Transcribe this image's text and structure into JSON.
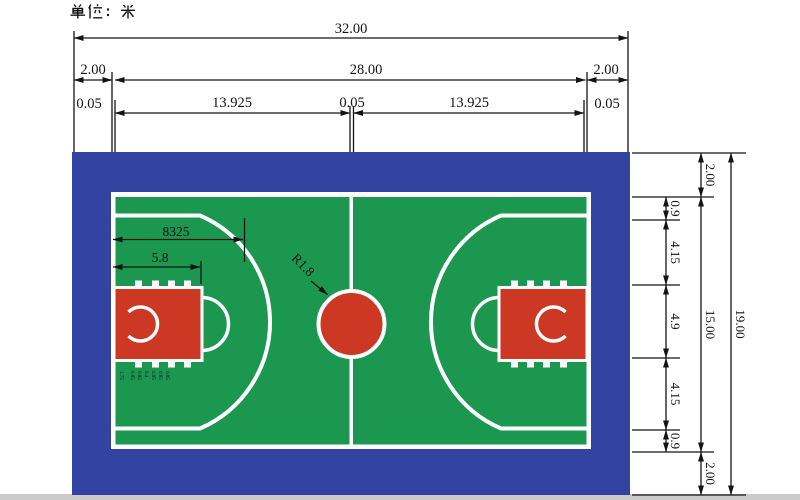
{
  "title": {
    "unit_label": "单位： 米"
  },
  "palette": {
    "apron_blue": "#3343a1",
    "court_green": "#1b9750",
    "paint_red": "#cd3825",
    "line_white": "#ffffff",
    "dim_black": "#141414",
    "footer_gray": "#cbcbcb"
  },
  "dimensions": {
    "top": {
      "overall": "32.00",
      "left_margin": "2.00",
      "court_length": "28.00",
      "right_margin": "2.00",
      "line_left": "0.05",
      "half_left": "13.925",
      "line_center": "0.05",
      "half_right": "13.925",
      "line_right": "0.05"
    },
    "right": {
      "overall": "19.00",
      "top_margin": "2.00",
      "court_width": "15.00",
      "bottom_margin": "2.00",
      "segments": [
        "0.9",
        "4.15",
        "4.9",
        "4.15",
        "0.9"
      ]
    },
    "inner": {
      "arc_depth": "8325",
      "key_length": "5.8",
      "center_radius": "R1.8"
    },
    "lane_marks": [
      "1.75",
      "0.85",
      "0.85",
      "0.4",
      "0.85",
      "0.85",
      "0.85"
    ]
  }
}
